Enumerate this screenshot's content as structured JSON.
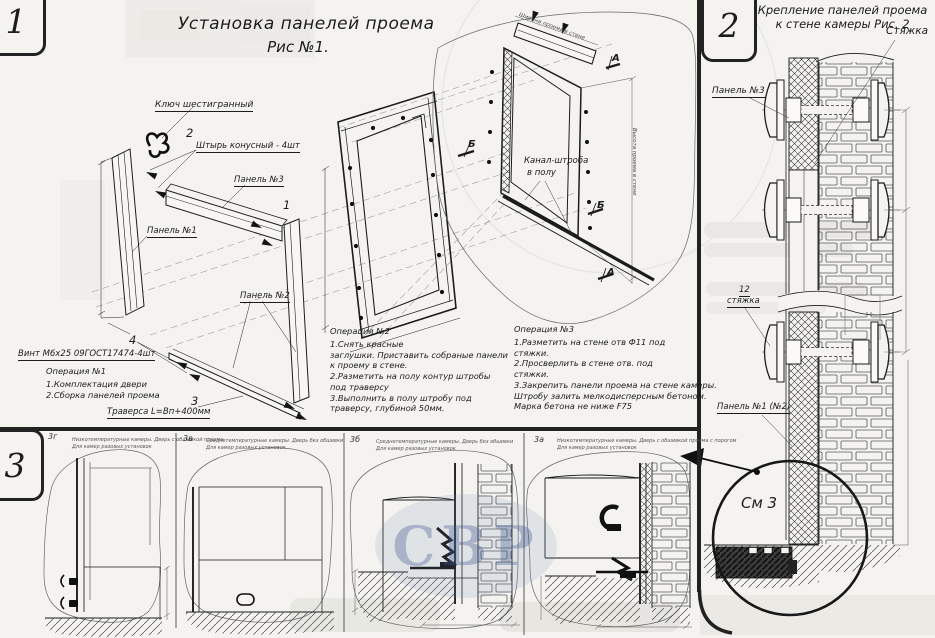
{
  "colors": {
    "ink": "#1c1c1c",
    "paper": "#f4f3f0",
    "watermark_blue": "#3e5891"
  },
  "fig1": {
    "badge": "1",
    "title": "Установка панелей проема",
    "subtitle": "Рис №1.",
    "labels": {
      "hex_key": "Ключ шестигранный",
      "pin_item": "2",
      "pin": "Штырь конусный - 4шт",
      "panel3": "Панель №3",
      "panel3_item": "1",
      "panel1": "Панель №1",
      "panel2": "Панель №2",
      "screw_item": "4",
      "screw": "Винт М6х25 09ГОСТ17474-4шт",
      "traverse_item": "3",
      "traverse": "Траверса  L=Вп+400мм",
      "channel_line1": "Канал-штроба",
      "channel_line2": "в полу",
      "marker_a": "А",
      "marker_b": "Б",
      "dim_width": "Ширина проема в стене",
      "dim_height": "Высота проема в стене"
    },
    "op1": {
      "title": "Операция №1",
      "lines": [
        "1.Комплектация двери",
        "2.Сборка панелей проема"
      ]
    },
    "op2": {
      "title": "Операция №2",
      "lines": [
        "1.Снять красные",
        "заглушки. Приставить собраные панели",
        "к проему в стене.",
        "2.Разметить на полу контур штробы",
        "под траверсу",
        "3.Выполнить в полу штробу под",
        "траверсу, глубиной 50мм."
      ]
    },
    "op3": {
      "title": "Операция №3",
      "lines": [
        "1.Разметить на стене отв Ф11 под",
        "стяжки.",
        "2.Просверлить в стене отв.  под",
        "стяжки.",
        "3.Закрепить панели проема на стене камеры.",
        "Штробу залить мелкодисперсным бетоном.",
        "Марка бетона не ниже   F75"
      ]
    }
  },
  "fig2": {
    "badge": "2",
    "title": "Крепление панелей проема",
    "subtitle": "к стене камеры  Рис. 2",
    "labels": {
      "tie": "Стяжка",
      "panel3": "Панель №3",
      "tie_item": "12",
      "tie_lower": "стяжка",
      "panel12": "Панель №1 (№2)"
    }
  },
  "fig3": {
    "badge": "3",
    "see_detail": "См 3",
    "subfigures": [
      {
        "id": "3г",
        "cap1": "Низкотемпературные камеры. Дверь с обшивкой проема",
        "cap2": "Для камер разовых установок"
      },
      {
        "id": "3в",
        "cap1": "Среднетемпературные камеры. Дверь без обшивки",
        "cap2": "Для камер разовых установок"
      },
      {
        "id": "3б",
        "cap1": "Среднетемпературные камеры. Дверь без обшивки",
        "cap2": "Для камер разовых установок"
      },
      {
        "id": "3а",
        "cap1": "Низкотемпературные камеры. Дверь с обшивкой проема с порогом",
        "cap2": "Для камер разовых установок"
      }
    ]
  },
  "watermark": "СВР"
}
